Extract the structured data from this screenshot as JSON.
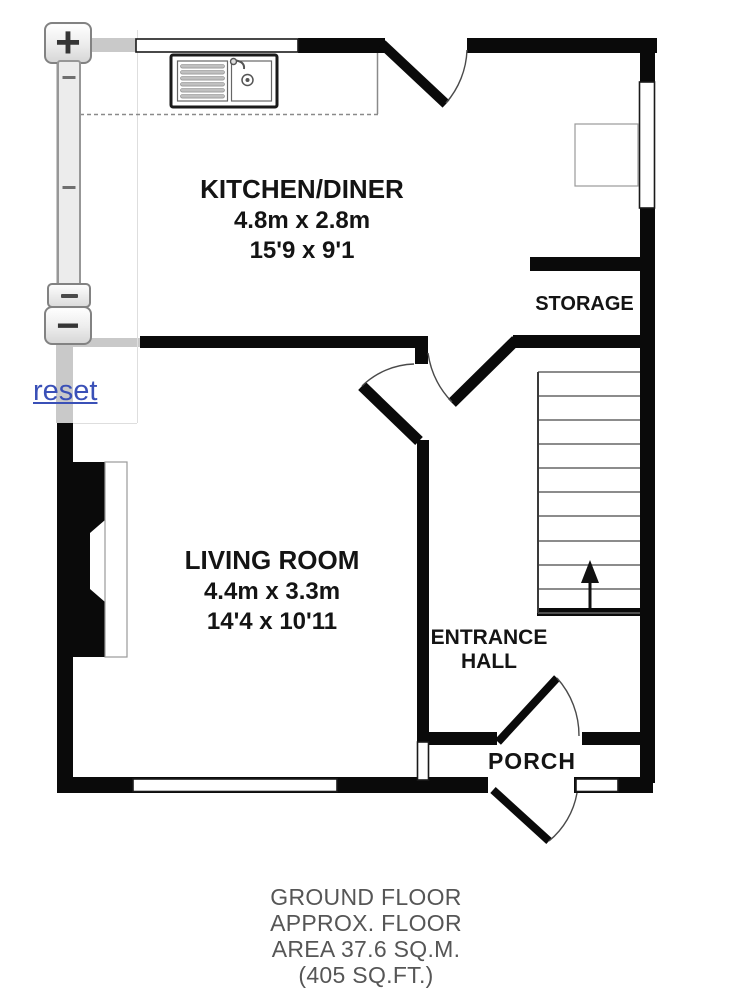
{
  "controls": {
    "zoom_in": "+",
    "zoom_out": "−",
    "reset": "reset"
  },
  "floorplan": {
    "kitchen": {
      "name": "KITCHEN/DINER",
      "metric": "4.8m x 2.8m",
      "imperial": "15'9 x 9'1"
    },
    "living": {
      "name": "LIVING ROOM",
      "metric": "4.4m x 3.3m",
      "imperial": "14'4 x 10'11"
    },
    "storage": {
      "name": "STORAGE"
    },
    "hall": {
      "name": "ENTRANCE HALL"
    },
    "porch": {
      "name": "PORCH"
    },
    "caption": {
      "line1": "GROUND FLOOR",
      "line2": "APPROX. FLOOR",
      "line3": "AREA 37.6 SQ.M.",
      "line4": "(405 SQ.FT.)"
    },
    "colors": {
      "wall": "#0a0a0a",
      "faded_wall": "#c9c9c9",
      "link_blue": "#3a50b7",
      "stair_tread": "#666666"
    }
  }
}
